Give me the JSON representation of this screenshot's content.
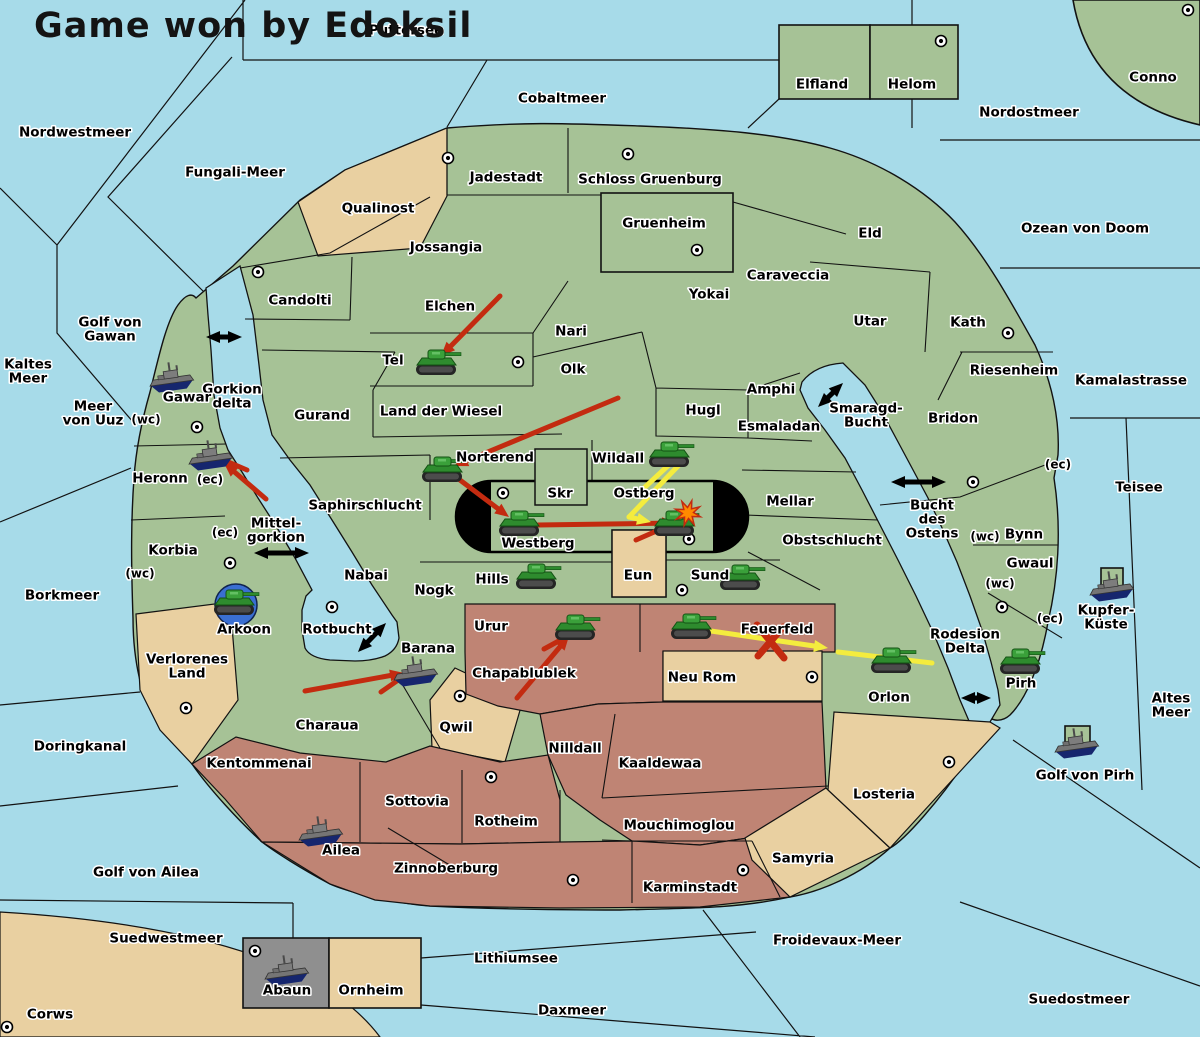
{
  "title": "Game won by Edoksil",
  "map": {
    "colors": {
      "sea": "#a7dbe9",
      "land_green": "#a6c296",
      "land_tan": "#e9d0a1",
      "land_maroon": "#bf8474",
      "land_gray": "#8f8f8f",
      "border": "#121212",
      "red_arrow": "#c32b10",
      "yellow_arrow": "#f4ec3e",
      "black_arrow": "#000000",
      "dislodged_blue": "#3a6fd2",
      "explosion_orange": "#ff8a00",
      "tank_green": "#2e8b2e",
      "ship_gray": "#757575",
      "ship_hull_navy": "#16266e"
    },
    "labels": [
      {
        "text": "Puttersee",
        "x": 406,
        "y": 30,
        "type": "sea"
      },
      {
        "text": "Cobaltmeer",
        "x": 562,
        "y": 98,
        "type": "sea"
      },
      {
        "text": "Nordwestmeer",
        "x": 75,
        "y": 132,
        "type": "sea"
      },
      {
        "text": "Fungali-Meer",
        "x": 235,
        "y": 172,
        "type": "sea"
      },
      {
        "text": "Nordostmeer",
        "x": 1029,
        "y": 112,
        "type": "sea"
      },
      {
        "text": "Ozean von Doom",
        "x": 1085,
        "y": 228,
        "type": "sea"
      },
      {
        "text": "Kaltes Meer",
        "lines": [
          "Kaltes",
          "Meer"
        ],
        "x": 28,
        "y": 371,
        "type": "sea"
      },
      {
        "text": "Golf von Gawan",
        "lines": [
          "Golf von",
          "Gawan"
        ],
        "x": 110,
        "y": 329,
        "type": "sea"
      },
      {
        "text": "Meer von Uuz",
        "lines": [
          "Meer",
          "von Uuz"
        ],
        "x": 93,
        "y": 413,
        "type": "sea"
      },
      {
        "text": "Gorkion delta",
        "lines": [
          "Gorkion",
          "delta"
        ],
        "x": 232,
        "y": 396,
        "type": "sea"
      },
      {
        "text": "Mittel-gorkion",
        "lines": [
          "Mittel-",
          "gorkion"
        ],
        "x": 276,
        "y": 530,
        "type": "sea"
      },
      {
        "text": "Borkmeer",
        "x": 62,
        "y": 595,
        "type": "sea"
      },
      {
        "text": "Doringkanal",
        "x": 80,
        "y": 746,
        "type": "sea"
      },
      {
        "text": "Golf von Ailea",
        "x": 146,
        "y": 872,
        "type": "sea"
      },
      {
        "text": "Suedwestmeer",
        "x": 166,
        "y": 938,
        "type": "sea"
      },
      {
        "text": "Daxmeer",
        "x": 572,
        "y": 1010,
        "type": "sea"
      },
      {
        "text": "Lithiumsee",
        "x": 516,
        "y": 958,
        "type": "sea"
      },
      {
        "text": "Froidevaux-Meer",
        "x": 837,
        "y": 940,
        "type": "sea"
      },
      {
        "text": "Suedostmeer",
        "x": 1079,
        "y": 999,
        "type": "sea"
      },
      {
        "text": "Altes Meer",
        "lines": [
          "Altes",
          "Meer"
        ],
        "x": 1171,
        "y": 705,
        "type": "sea"
      },
      {
        "text": "Teisee",
        "x": 1139,
        "y": 487,
        "type": "sea"
      },
      {
        "text": "Kamalastrasse",
        "x": 1131,
        "y": 380,
        "type": "sea"
      },
      {
        "text": "Golf von Pirh",
        "x": 1085,
        "y": 775,
        "type": "sea"
      },
      {
        "text": "Rotbucht",
        "x": 337,
        "y": 629,
        "type": "sea"
      },
      {
        "text": "Smaragd-Bucht",
        "lines": [
          "Smaragd-",
          "Bucht"
        ],
        "x": 866,
        "y": 415,
        "type": "sea"
      },
      {
        "text": "Bucht des Ostens",
        "lines": [
          "Bucht",
          "des",
          "Ostens"
        ],
        "x": 932,
        "y": 519,
        "type": "sea"
      },
      {
        "text": "Rodesion Delta",
        "lines": [
          "Rodesion",
          "Delta"
        ],
        "x": 965,
        "y": 641,
        "type": "sea"
      },
      {
        "text": "Corws",
        "x": 50,
        "y": 1014,
        "type": "land"
      },
      {
        "text": "Conno",
        "x": 1153,
        "y": 77,
        "type": "land"
      },
      {
        "text": "Elfland",
        "x": 822,
        "y": 84,
        "type": "land"
      },
      {
        "text": "Helom",
        "x": 912,
        "y": 84,
        "type": "land"
      },
      {
        "text": "Qualinost",
        "x": 378,
        "y": 208,
        "type": "land"
      },
      {
        "text": "Jadestadt",
        "x": 506,
        "y": 177,
        "type": "land"
      },
      {
        "text": "Schloss Gruenburg",
        "x": 650,
        "y": 179,
        "type": "land"
      },
      {
        "text": "Gruenheim",
        "x": 664,
        "y": 223,
        "type": "land"
      },
      {
        "text": "Jossangia",
        "x": 446,
        "y": 247,
        "type": "land"
      },
      {
        "text": "Candolti",
        "x": 300,
        "y": 300,
        "type": "land"
      },
      {
        "text": "Elchen",
        "x": 450,
        "y": 306,
        "type": "land"
      },
      {
        "text": "Nari",
        "x": 571,
        "y": 331,
        "type": "land"
      },
      {
        "text": "Yokai",
        "x": 709,
        "y": 294,
        "type": "land"
      },
      {
        "text": "Caraveccia",
        "x": 788,
        "y": 275,
        "type": "land"
      },
      {
        "text": "Eld",
        "x": 870,
        "y": 233,
        "type": "land"
      },
      {
        "text": "Utar",
        "x": 870,
        "y": 321,
        "type": "land"
      },
      {
        "text": "Kath",
        "x": 968,
        "y": 322,
        "type": "land"
      },
      {
        "text": "Riesenheim",
        "x": 1014,
        "y": 370,
        "type": "land"
      },
      {
        "text": "Bridon",
        "x": 953,
        "y": 418,
        "type": "land"
      },
      {
        "text": "Tel",
        "x": 393,
        "y": 360,
        "type": "land"
      },
      {
        "text": "Olk",
        "x": 573,
        "y": 369,
        "type": "land"
      },
      {
        "text": "Gurand",
        "x": 322,
        "y": 415,
        "type": "land"
      },
      {
        "text": "Land der Wiesel",
        "x": 441,
        "y": 411,
        "type": "land"
      },
      {
        "text": "Hugl",
        "x": 703,
        "y": 410,
        "type": "land"
      },
      {
        "text": "Amphi",
        "x": 771,
        "y": 389,
        "type": "land"
      },
      {
        "text": "Esmaladan",
        "x": 779,
        "y": 426,
        "type": "land"
      },
      {
        "text": "Gawar",
        "x": 187,
        "y": 397,
        "type": "land"
      },
      {
        "text": "Heronn",
        "x": 160,
        "y": 478,
        "type": "land"
      },
      {
        "text": "Korbia",
        "x": 173,
        "y": 550,
        "type": "land"
      },
      {
        "text": "Saphirschlucht",
        "x": 365,
        "y": 505,
        "type": "land"
      },
      {
        "text": "Norterend",
        "x": 495,
        "y": 457,
        "type": "land"
      },
      {
        "text": "Skr",
        "x": 560,
        "y": 493,
        "type": "land"
      },
      {
        "text": "Wildall",
        "x": 618,
        "y": 458,
        "type": "land"
      },
      {
        "text": "Ostberg",
        "x": 644,
        "y": 493,
        "type": "land"
      },
      {
        "text": "Westberg",
        "x": 538,
        "y": 543,
        "type": "land"
      },
      {
        "text": "Mellar",
        "x": 790,
        "y": 501,
        "type": "land"
      },
      {
        "text": "Obstschlucht",
        "x": 832,
        "y": 540,
        "type": "land"
      },
      {
        "text": "Nabai",
        "x": 366,
        "y": 575,
        "type": "land"
      },
      {
        "text": "Nogk",
        "x": 434,
        "y": 590,
        "type": "land"
      },
      {
        "text": "Hills",
        "x": 492,
        "y": 579,
        "type": "land"
      },
      {
        "text": "Eun",
        "x": 638,
        "y": 575,
        "type": "land"
      },
      {
        "text": "Sund",
        "x": 710,
        "y": 575,
        "type": "land"
      },
      {
        "text": "Arkoon",
        "x": 244,
        "y": 629,
        "type": "land"
      },
      {
        "text": "Barana",
        "x": 428,
        "y": 648,
        "type": "land"
      },
      {
        "text": "Urur",
        "x": 491,
        "y": 626,
        "type": "land"
      },
      {
        "text": "Feuerfeld",
        "x": 777,
        "y": 629,
        "type": "land"
      },
      {
        "text": "Chapablublek",
        "x": 524,
        "y": 673,
        "type": "land"
      },
      {
        "text": "Neu Rom",
        "x": 702,
        "y": 677,
        "type": "land"
      },
      {
        "text": "Orlon",
        "x": 889,
        "y": 697,
        "type": "land"
      },
      {
        "text": "Bynn",
        "x": 1024,
        "y": 534,
        "type": "land"
      },
      {
        "text": "Gwaul",
        "x": 1030,
        "y": 563,
        "type": "land"
      },
      {
        "text": "Pirh",
        "x": 1021,
        "y": 683,
        "type": "land"
      },
      {
        "text": "Kupfer-Küste",
        "lines": [
          "Kupfer-",
          "Küste"
        ],
        "x": 1106,
        "y": 617,
        "type": "land"
      },
      {
        "text": "Verlorenes Land",
        "lines": [
          "Verlorenes",
          "Land"
        ],
        "x": 187,
        "y": 666,
        "type": "land"
      },
      {
        "text": "Charaua",
        "x": 327,
        "y": 725,
        "type": "land"
      },
      {
        "text": "Qwil",
        "x": 456,
        "y": 727,
        "type": "land"
      },
      {
        "text": "Nilldall",
        "x": 575,
        "y": 748,
        "type": "land"
      },
      {
        "text": "Kaaldewaa",
        "x": 660,
        "y": 763,
        "type": "land"
      },
      {
        "text": "Kentommenai",
        "x": 259,
        "y": 763,
        "type": "land"
      },
      {
        "text": "Sottovia",
        "x": 417,
        "y": 801,
        "type": "land"
      },
      {
        "text": "Rotheim",
        "x": 506,
        "y": 821,
        "type": "land"
      },
      {
        "text": "Mouchimoglou",
        "x": 679,
        "y": 825,
        "type": "land"
      },
      {
        "text": "Zinnoberburg",
        "x": 446,
        "y": 868,
        "type": "land"
      },
      {
        "text": "Ailea",
        "x": 341,
        "y": 850,
        "type": "land"
      },
      {
        "text": "Karminstadt",
        "x": 690,
        "y": 887,
        "type": "land"
      },
      {
        "text": "Samyria",
        "x": 803,
        "y": 858,
        "type": "land"
      },
      {
        "text": "Losteria",
        "x": 884,
        "y": 794,
        "type": "land"
      },
      {
        "text": "Abaun",
        "x": 287,
        "y": 990,
        "type": "land"
      },
      {
        "text": "Ornheim",
        "x": 371,
        "y": 990,
        "type": "land"
      }
    ],
    "coast_labels": [
      {
        "text": "(wc)",
        "x": 146,
        "y": 419
      },
      {
        "text": "(ec)",
        "x": 210,
        "y": 479
      },
      {
        "text": "(ec)",
        "x": 225,
        "y": 532
      },
      {
        "text": "(wc)",
        "x": 140,
        "y": 573
      },
      {
        "text": "(ec)",
        "x": 1058,
        "y": 464
      },
      {
        "text": "(wc)",
        "x": 985,
        "y": 536
      },
      {
        "text": "(wc)",
        "x": 1000,
        "y": 583
      },
      {
        "text": "(ec)",
        "x": 1050,
        "y": 618
      }
    ],
    "supply_centers": [
      [
        448,
        158
      ],
      [
        628,
        154
      ],
      [
        697,
        250
      ],
      [
        941,
        41
      ],
      [
        1188,
        10
      ],
      [
        258,
        272
      ],
      [
        197,
        427
      ],
      [
        518,
        362
      ],
      [
        503,
        493
      ],
      [
        689,
        539
      ],
      [
        682,
        590
      ],
      [
        332,
        607
      ],
      [
        230,
        563
      ],
      [
        186,
        708
      ],
      [
        460,
        696
      ],
      [
        491,
        777
      ],
      [
        573,
        880
      ],
      [
        743,
        870
      ],
      [
        949,
        762
      ],
      [
        812,
        677
      ],
      [
        973,
        482
      ],
      [
        1002,
        607
      ],
      [
        255,
        951
      ],
      [
        7,
        1027
      ],
      [
        1008,
        333
      ]
    ],
    "units": {
      "armies": [
        {
          "region": "Tel",
          "x": 437,
          "y": 363
        },
        {
          "region": "Norterend",
          "x": 443,
          "y": 470
        },
        {
          "region": "Westberg",
          "x": 520,
          "y": 524
        },
        {
          "region": "Wildall",
          "x": 670,
          "y": 455
        },
        {
          "region": "Ostberg",
          "x": 675,
          "y": 524
        },
        {
          "region": "Hills",
          "x": 537,
          "y": 577
        },
        {
          "region": "Sund",
          "x": 741,
          "y": 578
        },
        {
          "region": "Arkoon",
          "x": 235,
          "y": 603,
          "dislodged": true
        },
        {
          "region": "Urur",
          "x": 576,
          "y": 628
        },
        {
          "region": "Feuerfeld",
          "x": 692,
          "y": 627
        },
        {
          "region": "Orlon",
          "x": 892,
          "y": 661
        },
        {
          "region": "Pirh",
          "x": 1021,
          "y": 662
        }
      ],
      "fleets": [
        {
          "region": "Gawar",
          "x": 172,
          "y": 377
        },
        {
          "region": "Heronn (ec)",
          "x": 211,
          "y": 455
        },
        {
          "region": "Barana",
          "x": 416,
          "y": 671
        },
        {
          "region": "Ailea",
          "x": 321,
          "y": 831
        },
        {
          "region": "Abaun",
          "x": 287,
          "y": 970
        },
        {
          "region": "Kupfer-Küste",
          "x": 1112,
          "y": 586
        },
        {
          "region": "Golf von Pirh",
          "x": 1077,
          "y": 743
        }
      ]
    },
    "arrows": {
      "red": [
        {
          "from": [
            500,
            296
          ],
          "to": [
            441,
            356
          ],
          "head": true
        },
        {
          "from": [
            618,
            398
          ],
          "to": [
            454,
            466
          ],
          "head": true
        },
        {
          "from": [
            452,
            474
          ],
          "to": [
            509,
            517
          ],
          "head": true
        },
        {
          "from": [
            538,
            525
          ],
          "to": [
            676,
            523
          ],
          "head": true
        },
        {
          "from": [
            636,
            540
          ],
          "to": [
            668,
            526
          ],
          "head": false
        },
        {
          "from": [
            266,
            499
          ],
          "to": [
            224,
            463
          ],
          "head": true
        },
        {
          "from": [
            247,
            470
          ],
          "to": [
            226,
            461
          ],
          "head": false
        },
        {
          "from": [
            305,
            691
          ],
          "to": [
            404,
            673
          ],
          "head": true
        },
        {
          "from": [
            381,
            692
          ],
          "to": [
            404,
            676
          ],
          "head": false
        },
        {
          "from": [
            517,
            698
          ],
          "to": [
            569,
            636
          ],
          "head": true
        },
        {
          "from": [
            544,
            649
          ],
          "to": [
            566,
            637
          ],
          "head": false
        }
      ],
      "yellow": [
        {
          "from": [
            672,
            462
          ],
          "to": [
            643,
            489
          ],
          "head": false
        },
        {
          "from": [
            679,
            465
          ],
          "to": [
            629,
            517
          ],
          "head": false
        },
        {
          "from": [
            629,
            517
          ],
          "to": [
            651,
            522
          ],
          "head": true
        },
        {
          "from": [
            704,
            630
          ],
          "to": [
            828,
            648
          ],
          "head": true
        },
        {
          "from": [
            932,
            663
          ],
          "to": [
            838,
            652
          ],
          "head": false
        }
      ],
      "black_double": [
        {
          "from": [
            206,
            337
          ],
          "to": [
            242,
            337
          ]
        },
        {
          "from": [
            254,
            553
          ],
          "to": [
            309,
            553
          ]
        },
        {
          "from": [
            358,
            652
          ],
          "to": [
            386,
            623
          ]
        },
        {
          "from": [
            818,
            407
          ],
          "to": [
            843,
            383
          ]
        },
        {
          "from": [
            891,
            482
          ],
          "to": [
            946,
            482
          ]
        },
        {
          "from": [
            961,
            698
          ],
          "to": [
            991,
            698
          ]
        }
      ]
    },
    "x_mark": {
      "x": 770,
      "y": 641
    },
    "explosion": {
      "x": 688,
      "y": 513
    }
  }
}
